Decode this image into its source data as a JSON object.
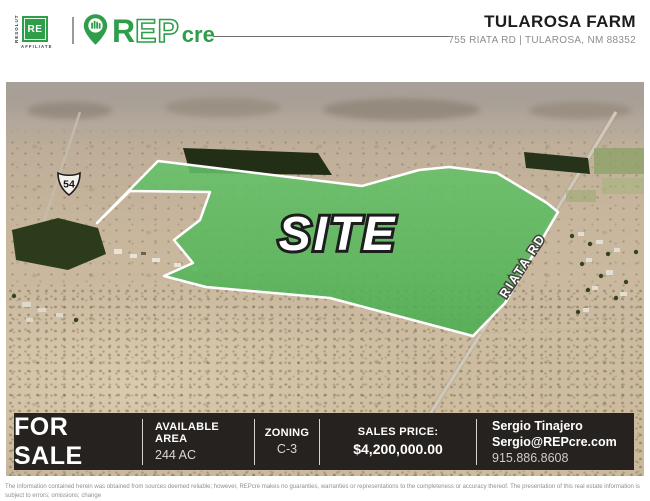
{
  "header": {
    "affiliate": {
      "vertical": "RESOLUT",
      "badge": "RE",
      "bottom": "AFFILIATE"
    },
    "brand": {
      "r": "R",
      "ep": "EP",
      "cre": "cre"
    },
    "property_name": "TULAROSA FARM",
    "property_address": "755 RIATA RD | TULAROSA, NM 88352"
  },
  "map": {
    "site_label": "SITE",
    "road_label": "RIATA RD",
    "highway_shield": "54"
  },
  "info_bar": {
    "for_sale": "FOR SALE",
    "available_area_label": "AVAILABLE AREA",
    "available_area_value": "244 AC",
    "zoning_label": "ZONING",
    "zoning_value": "C-3",
    "sales_price_label": "SALES PRICE:",
    "sales_price_value": "$4,200,000.00",
    "contact": {
      "name": "Sergio Tinajero",
      "email": "Sergio@REPcre.com",
      "phone": "915.886.8608"
    }
  },
  "disclaimer": {
    "line1": "The information contained herein was obtained from sources deemed reliable; however, REPcre makes no guaranties, warranties or representations to the completeness or accuracy thereof. The presentation of this real estate information is subject to errors; omissions; change",
    "line2": "of price; prior sale or lease; or withdrawal without notice. REPcre, which provides real estate brokerage services, is a affiliate of RESOLUT RE."
  },
  "colors": {
    "brand_green": "#2f9e4a",
    "site_overlay_green": "#56b65c",
    "bar_background": "#26221f"
  }
}
